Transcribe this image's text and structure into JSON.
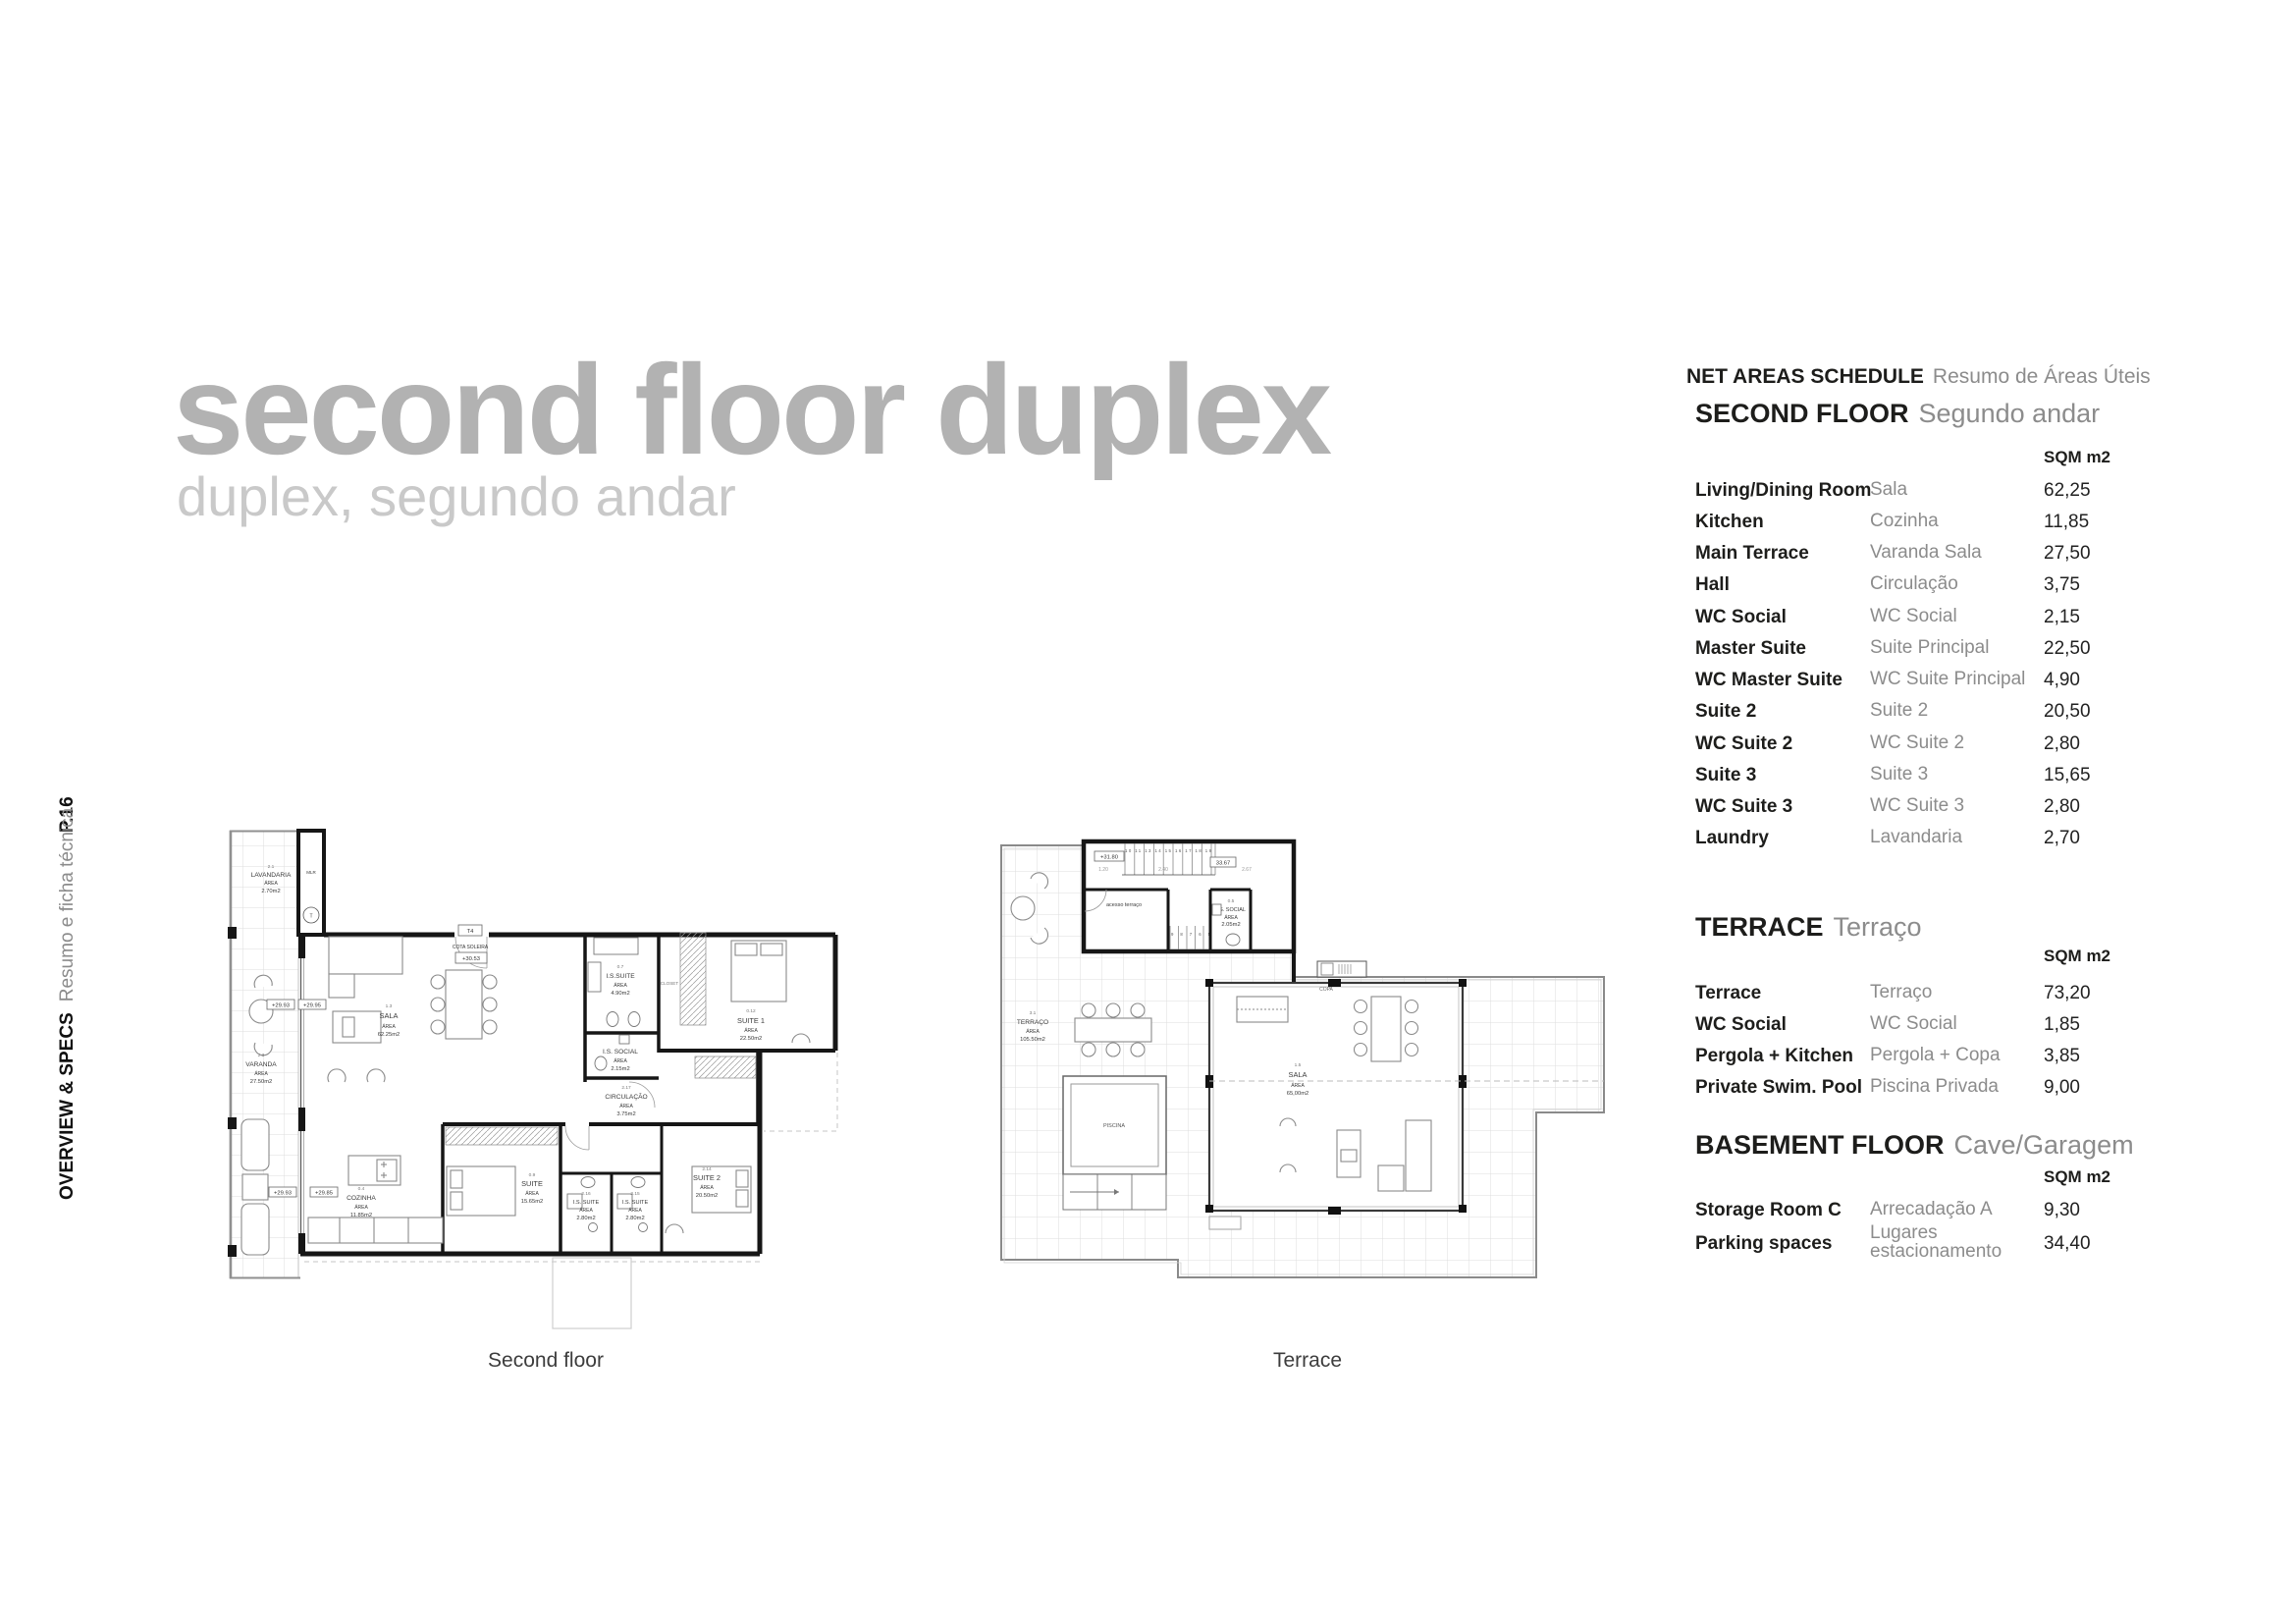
{
  "page": {
    "number": "P.16",
    "section_en": "OVERVIEW & SPECS",
    "section_pt": "Resumo e ficha técnica"
  },
  "title": {
    "main": "second floor duplex",
    "sub": "duplex, segundo andar"
  },
  "schedule": {
    "header_en": "NET AREAS SCHEDULE",
    "header_pt": "Resumo de Áreas Úteis",
    "sections": [
      {
        "title_en": "SECOND FLOOR",
        "title_pt": "Segundo andar",
        "unit": "SQM m2",
        "rows": [
          {
            "en": "Living/Dining Room",
            "pt": "Sala",
            "sqm": "62,25"
          },
          {
            "en": "Kitchen",
            "pt": "Cozinha",
            "sqm": "11,85"
          },
          {
            "en": "Main Terrace",
            "pt": "Varanda Sala",
            "sqm": "27,50"
          },
          {
            "en": "Hall",
            "pt": "Circulação",
            "sqm": "3,75"
          },
          {
            "en": "WC Social",
            "pt": "WC Social",
            "sqm": "2,15"
          },
          {
            "en": "Master Suite",
            "pt": "Suite Principal",
            "sqm": "22,50"
          },
          {
            "en": "WC Master Suite",
            "pt": "WC Suite Principal",
            "sqm": "4,90"
          },
          {
            "en": "Suite 2",
            "pt": "Suite 2",
            "sqm": "20,50"
          },
          {
            "en": "WC Suite 2",
            "pt": "WC Suite 2",
            "sqm": "2,80"
          },
          {
            "en": "Suite 3",
            "pt": "Suite 3",
            "sqm": "15,65"
          },
          {
            "en": "WC Suite 3",
            "pt": "WC Suite 3",
            "sqm": "2,80"
          },
          {
            "en": "Laundry",
            "pt": "Lavandaria",
            "sqm": "2,70"
          }
        ]
      },
      {
        "title_en": "TERRACE",
        "title_pt": "Terraço",
        "unit": "SQM m2",
        "rows": [
          {
            "en": "Terrace",
            "pt": "Terraço",
            "sqm": "73,20"
          },
          {
            "en": "WC Social",
            "pt": "WC Social",
            "sqm": "1,85"
          },
          {
            "en": "Pergola + Kitchen",
            "pt": "Pergola + Copa",
            "sqm": "3,85"
          },
          {
            "en": "Private Swim. Pool",
            "pt": "Piscina Privada",
            "sqm": "9,00"
          }
        ]
      },
      {
        "title_en": "BASEMENT FLOOR",
        "title_pt": "Cave/Garagem",
        "unit": "SQM m2",
        "rows": [
          {
            "en": "Storage Room C",
            "pt": "Arrecadação A",
            "sqm": "9,30"
          },
          {
            "en": "Parking spaces",
            "pt": "Lugares estacionamento",
            "sqm": "34,40"
          }
        ]
      }
    ]
  },
  "plans": {
    "second_floor": {
      "caption": "Second floor",
      "labels": {
        "lavandaria": [
          "2.1",
          "LAVANDARIA",
          "ÁREA",
          "2.70m2"
        ],
        "mlr": "MLR",
        "t": "T",
        "varanda": [
          "2.3",
          "VARANDA",
          "ÁREA",
          "27.50m2"
        ],
        "sala": [
          "1.3",
          "SALA",
          "ÁREA",
          "62.25m2"
        ],
        "t4": "T4",
        "cota_soleira": "COTA SOLEIRA",
        "cota_valor": "+30.53",
        "nivel_a": "+29.93",
        "nivel_b": "+29.95",
        "nivel_c": "+29.93",
        "nivel_d": "+29.85",
        "is_suite_master": [
          "0.7",
          "I.S.SUITE",
          "ÁREA",
          "4.90m2"
        ],
        "closet": "CLOSET",
        "suite1": [
          "0.12",
          "SUITE 1",
          "ÁREA",
          "22.50m2"
        ],
        "is_social": [
          "I.S. SOCIAL",
          "ÁREA",
          "2.15m2"
        ],
        "circulacao": [
          "2.17",
          "CIRCULAÇÃO",
          "ÁREA",
          "3.75m2"
        ],
        "cozinha": [
          "0.4",
          "COZINHA",
          "ÁREA",
          "11.85m2"
        ],
        "suite3": [
          "0.9",
          "SUITE",
          "ÁREA",
          "15.65m2"
        ],
        "is_suite2": [
          "2.16",
          "I.S. SUITE",
          "ÁREA",
          "2.80m2"
        ],
        "is_suite3": [
          "2.15",
          "I.S. SUITE",
          "ÁREA",
          "2.80m2"
        ],
        "suite2": [
          "2.14",
          "SUITE 2",
          "ÁREA",
          "20.50m2"
        ]
      }
    },
    "terrace": {
      "caption": "Terrace",
      "labels": {
        "terraco": [
          "3.1",
          "TERRAÇO",
          "ÁREA",
          "105.50m2"
        ],
        "sala": [
          "1.5",
          "SALA",
          "ÁREA",
          "65,00m2"
        ],
        "is_social": [
          "0.5",
          "I.S. SOCIAL",
          "ÁREA",
          "2.05m2"
        ],
        "piscina": "PISCINA",
        "copa": "COPA",
        "acesso": "acesso terraço",
        "nivel": "+31.80",
        "dim_total": "33.67",
        "dim_1": "1.20",
        "dim_2": "2.40",
        "dim_3": "2.67",
        "steps_upper": "10 11 13 14 15 16 17 18 19",
        "steps_lower": "9 8 7 6 5"
      }
    }
  }
}
